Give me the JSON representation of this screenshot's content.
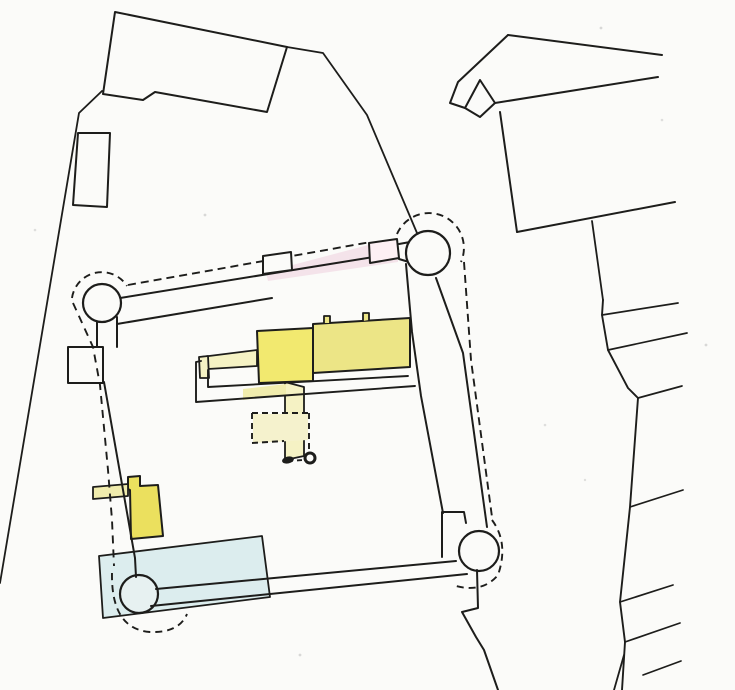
{
  "canvas": {
    "width": 735,
    "height": 690,
    "background": "#fbfbf9"
  },
  "palette": {
    "ink": "#1d1d1b",
    "paper": "#fbfbf9",
    "yellow_bright": "#f2e96f",
    "yellow_range": "#ece586",
    "yellow_pale": "#f5f2c4",
    "yellow_outbuilding": "#ebe05e",
    "yellow_strip": "#f0ecad",
    "water_blue": "#dcedee",
    "tower_wash": "#e7f1f1",
    "pink_wash": "rgba(233,183,206,0.35)",
    "speckle": "rgba(60,60,60,0.18)"
  },
  "shapes": [
    {
      "name": "pond-water",
      "type": "path",
      "d": "M 99,556 L 262,536 L 270,597 L 103,618 Z",
      "fill": "#dcedee",
      "stroke": "#1d1d1b",
      "sw": 1.8
    },
    {
      "name": "sw-corner-tower",
      "type": "circle",
      "cx": 139,
      "cy": 594,
      "r": 19,
      "fill": "#e7f1f1",
      "stroke": "#1d1d1b",
      "sw": 2.2
    },
    {
      "name": "west-wing-strip",
      "type": "path",
      "d": "M 201,357 L 257,350 L 257,366 L 208,369 Z",
      "fill": "#f5f2c4",
      "stroke": "#1d1d1b",
      "sw": 1.8
    },
    {
      "name": "west-wing-endcap",
      "type": "path",
      "d": "M 199,357 L 208,356 L 209,378 L 200,378 Z",
      "fill": "#f5f2c4",
      "stroke": "#1d1d1b",
      "sw": 1.8
    },
    {
      "name": "service-corridor",
      "type": "path",
      "d": "M 285,382 L 285,460 L 304,456 L 304,387 Z",
      "fill": "#f5f2c4",
      "stroke": "#1d1d1b",
      "sw": 1.8
    },
    {
      "name": "terrace-tinted-band",
      "type": "path",
      "d": "M 243,389 L 286,384 L 286,395 L 243,400 Z",
      "fill": "#f0ecad"
    },
    {
      "name": "terrace-outer-wall",
      "type": "path",
      "d": "M 201,361 L 196,362 L 196,402 L 415,386",
      "fill": "none",
      "stroke": "#1d1d1b",
      "sw": 1.9
    },
    {
      "name": "terrace-inner-wall",
      "type": "path",
      "d": "M 208,370 L 208,387 L 408,376",
      "fill": "none",
      "stroke": "#1d1d1b",
      "sw": 1.9
    },
    {
      "name": "main-range-building",
      "type": "path",
      "d": "M 313,324 L 410,318 L 410,367 L 313,373 Z",
      "fill": "#ece586",
      "stroke": "#1d1d1b",
      "sw": 2
    },
    {
      "name": "range-chimney-west",
      "type": "path",
      "d": "M 324,323 L 324,316 L 330,316 L 330,323",
      "fill": "#ece586",
      "stroke": "#1d1d1b",
      "sw": 1.8
    },
    {
      "name": "range-chimney-east",
      "type": "path",
      "d": "M 363,321 L 363,313 L 369,313 L 369,320",
      "fill": "#ece586",
      "stroke": "#1d1d1b",
      "sw": 1.8
    },
    {
      "name": "square-tower-keep",
      "type": "path",
      "d": "M 257,331 L 313,328 L 313,381 L 259,383 Z",
      "fill": "#f2e96f",
      "stroke": "#1d1d1b",
      "sw": 2
    },
    {
      "name": "courtyard-fill",
      "type": "path",
      "d": "M 253,414 L 308,414 L 308,440 L 253,443 Z",
      "fill": "#f5f2cd"
    },
    {
      "name": "courtyard-dashed-outline",
      "type": "path",
      "d": "M 252,413 L 309,413 M 252,413 L 252,443 M 252,443 L 284,441 M 309,413 L 309,453",
      "fill": "none",
      "stroke": "#1d1d1b",
      "sw": 1.9,
      "dash": "6 4"
    },
    {
      "name": "well-dashed-link",
      "type": "path",
      "d": "M 288,461 L 303,460",
      "fill": "none",
      "stroke": "#1d1d1b",
      "sw": 1.9,
      "dash": "5 4"
    },
    {
      "name": "well-marker-solid",
      "type": "ellipse",
      "cx": 288,
      "cy": 460,
      "rx": 6,
      "ry": 3.5,
      "rot": -12,
      "fill": "#1d1d1b"
    },
    {
      "name": "well-marker-ring",
      "type": "circle",
      "cx": 310,
      "cy": 458,
      "r": 5,
      "fill": "#fbfbf9",
      "stroke": "#1d1d1b",
      "sw": 3
    },
    {
      "name": "west-outbuilding",
      "type": "path",
      "d": "M 128,477 L 140,476 L 140,486 L 158,485 L 163,536 L 131,539 L 130,490 L 128,489 Z",
      "fill": "#ebe05e",
      "stroke": "#1d1d1b",
      "sw": 2
    },
    {
      "name": "west-wall-bar",
      "type": "path",
      "d": "M 93,487 L 128,484 L 128,496 L 93,499 Z",
      "fill": "#f0ecad",
      "stroke": "#1d1d1b",
      "sw": 1.8
    },
    {
      "name": "north-wall-pink-wash",
      "type": "path",
      "d": "M 266,272 L 372,244 L 398,253 L 398,262 L 268,281 Z",
      "fill": "rgba(233,183,206,0.35)"
    },
    {
      "name": "north-wall-outer-face",
      "type": "path",
      "d": "M 120,298 L 398,253",
      "fill": "none",
      "stroke": "#1d1d1b",
      "sw": 2
    },
    {
      "name": "north-wall-inner-face",
      "type": "path",
      "d": "M 117,324 L 272,298",
      "fill": "none",
      "stroke": "#1d1d1b",
      "sw": 2
    },
    {
      "name": "north-wall-dashed-edge",
      "type": "path",
      "d": "M 128,285 L 371,242",
      "fill": "none",
      "stroke": "#1d1d1b",
      "sw": 1.9,
      "dash": "8 5"
    },
    {
      "name": "north-wall-buttress-west",
      "type": "path",
      "d": "M 263,274 L 263,256 L 291,252 L 292,270 Z",
      "fill": "#fbfbf9",
      "stroke": "#1d1d1b",
      "sw": 2
    },
    {
      "name": "north-wall-buttress-east",
      "type": "path",
      "d": "M 370,263 L 369,243 L 397,239 L 399,258 Z",
      "fill": "#fdf0f4",
      "stroke": "#1d1d1b",
      "sw": 2
    },
    {
      "name": "nw-tower-neck",
      "type": "path",
      "d": "M 97,318 L 97,348 M 117,317 L 117,347",
      "fill": "none",
      "stroke": "#1d1d1b",
      "sw": 2
    },
    {
      "name": "nw-corner-tower",
      "type": "circle",
      "cx": 102,
      "cy": 303,
      "r": 19,
      "fill": "#fbfbf9",
      "stroke": "#1d1d1b",
      "sw": 2.2
    },
    {
      "name": "west-wall-square",
      "type": "path",
      "d": "M 68,347 L 103,347 L 103,383 L 68,383 Z",
      "fill": "#fbfbf9",
      "stroke": "#1d1d1b",
      "sw": 2
    },
    {
      "name": "west-curtain-wall",
      "type": "path",
      "d": "M 104,382 L 135,558 L 136,577",
      "fill": "none",
      "stroke": "#1d1d1b",
      "sw": 2
    },
    {
      "name": "south-wall-inner-face",
      "type": "path",
      "d": "M 156,589 L 456,561",
      "fill": "none",
      "stroke": "#1d1d1b",
      "sw": 2
    },
    {
      "name": "south-wall-outer-face",
      "type": "path",
      "d": "M 151,606 L 467,574",
      "fill": "none",
      "stroke": "#1d1d1b",
      "sw": 2
    },
    {
      "name": "east-wall-inner-face",
      "type": "path",
      "d": "M 406,264 L 412,332 L 421,396 L 443,513",
      "fill": "none",
      "stroke": "#1d1d1b",
      "sw": 2
    },
    {
      "name": "east-wall-outer-face",
      "type": "path",
      "d": "M 436,278 L 463,353 L 487,527",
      "fill": "none",
      "stroke": "#1d1d1b",
      "sw": 2
    },
    {
      "name": "east-wall-dashed-edge",
      "type": "path",
      "d": "M 464,262 L 471,360 L 492,517",
      "fill": "none",
      "stroke": "#1d1d1b",
      "sw": 1.9,
      "dash": "8 5"
    },
    {
      "name": "se-gatehouse",
      "type": "path",
      "d": "M 442,557 L 442,512 L 464,512 L 466,523",
      "fill": "none",
      "stroke": "#1d1d1b",
      "sw": 2
    },
    {
      "name": "se-corner-tower",
      "type": "circle",
      "cx": 479,
      "cy": 551,
      "r": 20,
      "fill": "#fbfbf9",
      "stroke": "#1d1d1b",
      "sw": 2.2
    },
    {
      "name": "south-boundary-zigzag",
      "type": "path",
      "d": "M 477,570 L 478,608 L 462,612 L 476,637 L 484,650 L 498,690",
      "fill": "none",
      "stroke": "#1d1d1b",
      "sw": 2
    },
    {
      "name": "ne-tower-neck",
      "type": "path",
      "d": "M 399,244 L 410,242 M 399,259 L 409,262",
      "fill": "none",
      "stroke": "#1d1d1b",
      "sw": 2
    },
    {
      "name": "ne-corner-tower",
      "type": "circle",
      "cx": 428,
      "cy": 253,
      "r": 22,
      "fill": "#fbfbf9",
      "stroke": "#1d1d1b",
      "sw": 2.2
    },
    {
      "name": "nw-tower-dashed-arc",
      "type": "path",
      "d": "M 72,298 A 30 30 0 0 1 127,286",
      "fill": "none",
      "stroke": "#1d1d1b",
      "sw": 1.9,
      "dash": "7 5"
    },
    {
      "name": "ne-tower-dashed-arc",
      "type": "path",
      "d": "M 397,234 A 32 32 0 0 1 461,262",
      "fill": "none",
      "stroke": "#1d1d1b",
      "sw": 1.9,
      "dash": "7 5"
    },
    {
      "name": "west-dashed-line",
      "type": "path",
      "d": "M 73,303 L 93,347 L 100,385 L 108,470 L 112,520 L 114,566",
      "fill": "none",
      "stroke": "#1d1d1b",
      "sw": 1.9,
      "dash": "8 6"
    },
    {
      "name": "sw-tower-dashed-arc",
      "type": "path",
      "d": "M 112,573 Q 111,629 150,632 Q 179,633 187,614",
      "fill": "none",
      "stroke": "#1d1d1b",
      "sw": 1.9,
      "dash": "7 5"
    },
    {
      "name": "se-tower-dashed-arc",
      "type": "path",
      "d": "M 492,520 Q 509,543 498,575 Q 483,593 456,586",
      "fill": "none",
      "stroke": "#1d1d1b",
      "sw": 1.9,
      "dash": "7 5"
    },
    {
      "name": "nw-large-building",
      "type": "path",
      "d": "M 115,12 L 287,47 L 267,112 L 155,92 L 143,100 L 103,94 Z",
      "fill": "#fbfbf9",
      "stroke": "#1d1d1b",
      "sw": 2
    },
    {
      "name": "nw-strip-building",
      "type": "path",
      "d": "M 78,133 L 110,133 L 107,207 L 73,205 Z",
      "fill": "#fbfbf9",
      "stroke": "#1d1d1b",
      "sw": 2
    },
    {
      "name": "west-boundary-line",
      "type": "path",
      "d": "M 102,91 L 79,113 L 0,583",
      "fill": "none",
      "stroke": "#1d1d1b",
      "sw": 1.8
    },
    {
      "name": "north-boundary-diagonal",
      "type": "path",
      "d": "M 287,47 L 323,53 L 367,115 L 417,233",
      "fill": "none",
      "stroke": "#1d1d1b",
      "sw": 1.8
    },
    {
      "name": "ne-building-ridge",
      "type": "path",
      "d": "M 508,35 L 662,55",
      "fill": "none",
      "stroke": "#1d1d1b",
      "sw": 2
    },
    {
      "name": "ne-building-west-edge",
      "type": "path",
      "d": "M 508,35 L 458,82 L 450,103 L 465,108",
      "fill": "none",
      "stroke": "#1d1d1b",
      "sw": 2
    },
    {
      "name": "ne-building-gable-wedge",
      "type": "path",
      "d": "M 465,108 L 480,80 L 495,103 L 480,117 Z",
      "fill": "#fbfbf9",
      "stroke": "#1d1d1b",
      "sw": 2
    },
    {
      "name": "ne-building-inner-line",
      "type": "path",
      "d": "M 495,103 L 658,77",
      "fill": "none",
      "stroke": "#1d1d1b",
      "sw": 2
    },
    {
      "name": "ne-building-side-wall",
      "type": "path",
      "d": "M 500,112 L 517,232",
      "fill": "none",
      "stroke": "#1d1d1b",
      "sw": 2
    },
    {
      "name": "ne-building-south-edge",
      "type": "path",
      "d": "M 517,232 L 675,202",
      "fill": "none",
      "stroke": "#1d1d1b",
      "sw": 2
    },
    {
      "name": "ne-boundary-connector",
      "type": "path",
      "d": "M 592,221 L 603,300",
      "fill": "none",
      "stroke": "#1d1d1b",
      "sw": 1.8
    },
    {
      "name": "east-boundary-polyline",
      "type": "path",
      "d": "M 603,300 L 602,315 L 608,350 L 628,388 L 638,398 L 630,507 L 620,602 L 625,642 L 622,690",
      "fill": "none",
      "stroke": "#1d1d1b",
      "sw": 1.9
    },
    {
      "name": "east-boundary-fork",
      "type": "path",
      "d": "M 624,655 L 614,690",
      "fill": "none",
      "stroke": "#1d1d1b",
      "sw": 1.8
    },
    {
      "name": "field-branch-1",
      "type": "path",
      "d": "M 602,315 L 678,303",
      "fill": "none",
      "stroke": "#1d1d1b",
      "sw": 1.7
    },
    {
      "name": "field-branch-2",
      "type": "path",
      "d": "M 608,350 L 687,333",
      "fill": "none",
      "stroke": "#1d1d1b",
      "sw": 1.7
    },
    {
      "name": "field-branch-3",
      "type": "path",
      "d": "M 638,398 L 682,386",
      "fill": "none",
      "stroke": "#1d1d1b",
      "sw": 1.7
    },
    {
      "name": "field-branch-4",
      "type": "path",
      "d": "M 630,507 L 683,490",
      "fill": "none",
      "stroke": "#1d1d1b",
      "sw": 1.7
    },
    {
      "name": "field-branch-5",
      "type": "path",
      "d": "M 620,602 L 673,585",
      "fill": "none",
      "stroke": "#1d1d1b",
      "sw": 1.7
    },
    {
      "name": "field-branch-6",
      "type": "path",
      "d": "M 625,642 L 680,623",
      "fill": "none",
      "stroke": "#1d1d1b",
      "sw": 1.7
    },
    {
      "name": "field-branch-7",
      "type": "path",
      "d": "M 643,675 L 681,661",
      "fill": "none",
      "stroke": "#1d1d1b",
      "sw": 1.7
    },
    {
      "name": "paper-speckle",
      "type": "circle",
      "cx": 205,
      "cy": 215,
      "r": 1.4,
      "fill": "rgba(60,60,60,0.18)"
    },
    {
      "name": "paper-speckle",
      "type": "circle",
      "cx": 601,
      "cy": 28,
      "r": 1.4,
      "fill": "rgba(60,60,60,0.18)"
    },
    {
      "name": "paper-speckle",
      "type": "circle",
      "cx": 662,
      "cy": 120,
      "r": 1.3,
      "fill": "rgba(60,60,60,0.15)"
    },
    {
      "name": "paper-speckle",
      "type": "circle",
      "cx": 545,
      "cy": 425,
      "r": 1.3,
      "fill": "rgba(60,60,60,0.15)"
    },
    {
      "name": "paper-speckle",
      "type": "circle",
      "cx": 300,
      "cy": 655,
      "r": 1.4,
      "fill": "rgba(60,60,60,0.18)"
    },
    {
      "name": "paper-speckle",
      "type": "circle",
      "cx": 35,
      "cy": 230,
      "r": 1.3,
      "fill": "rgba(60,60,60,0.15)"
    },
    {
      "name": "paper-speckle",
      "type": "circle",
      "cx": 706,
      "cy": 345,
      "r": 1.4,
      "fill": "rgba(60,60,60,0.18)"
    },
    {
      "name": "paper-speckle",
      "type": "circle",
      "cx": 585,
      "cy": 480,
      "r": 1.2,
      "fill": "rgba(60,60,60,0.14)"
    }
  ]
}
